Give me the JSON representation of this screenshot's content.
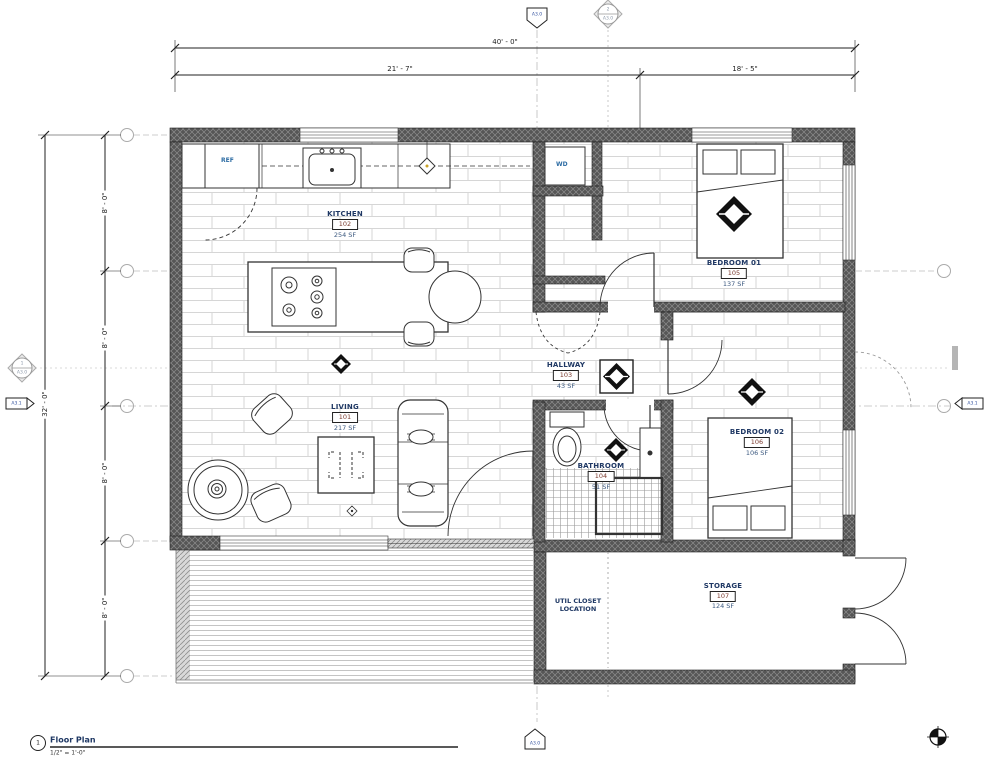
{
  "title_block": {
    "detail_number": "1",
    "view_title": "Floor Plan",
    "view_scale": "1/2\" = 1'-0\""
  },
  "dimensions": {
    "top_total": "40' - 0\"",
    "top_left_segment": "21' - 7\"",
    "top_right_segment": "18' - 5\"",
    "left_total": "32' - 0\"",
    "left_segments": [
      "8' - 0\"",
      "8' - 0\"",
      "8' - 0\"",
      "8' - 0\""
    ]
  },
  "rooms": {
    "living": {
      "name": "LIVING",
      "number": "101",
      "area": "217 SF"
    },
    "kitchen": {
      "name": "KITCHEN",
      "number": "102",
      "area": "254 SF"
    },
    "hallway": {
      "name": "HALLWAY",
      "number": "103",
      "area": "43 SF"
    },
    "bathroom": {
      "name": "BATHROOM",
      "number": "104",
      "area": "51 SF"
    },
    "bedroom01": {
      "name": "BEDROOM 01",
      "number": "105",
      "area": "137 SF"
    },
    "bedroom02": {
      "name": "BEDROOM 02",
      "number": "106",
      "area": "106 SF"
    },
    "storage": {
      "name": "STORAGE",
      "number": "107",
      "area": "124 SF"
    }
  },
  "labels": {
    "refrigerator": "REF",
    "washer_dryer": "WD",
    "util_closet": "UTIL CLOSET LOCATION"
  },
  "markers": {
    "top_section_sheet": "A3.0",
    "top_detail_number": "2",
    "top_detail_sheet": "A3.0",
    "left_section_number": "1",
    "left_section_sheet": "A3.0",
    "left_elevation_sheet": "A3.1",
    "right_elevation_sheet": "A3.1",
    "bottom_section_sheet": "A3.0"
  },
  "colors": {
    "room_name": "#1f3864",
    "room_number": "#7b3a2e",
    "room_area": "#3d5a80",
    "appliance_label": "#2e6da4",
    "wall_fill": "#555555",
    "marker_text": "#2f4f9e"
  }
}
